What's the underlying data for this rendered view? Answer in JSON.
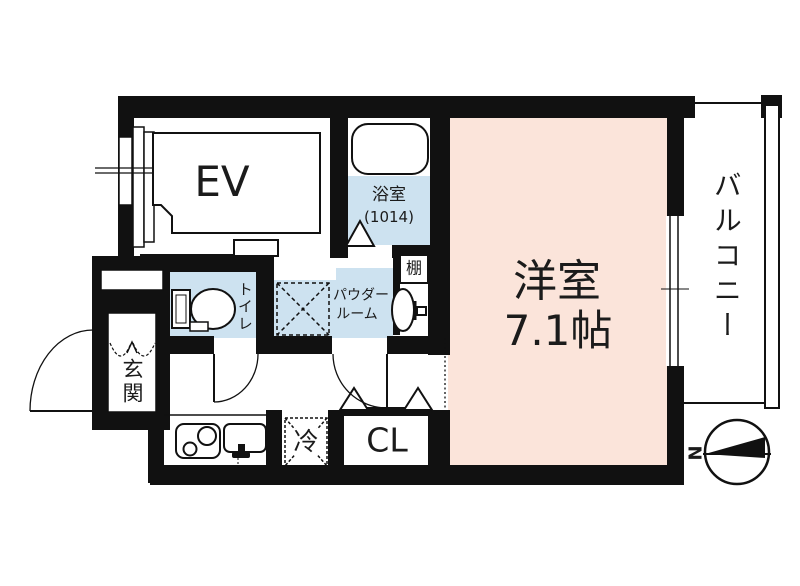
{
  "rooms": {
    "elevator": {
      "label": "EV"
    },
    "bathroom": {
      "label": "浴室",
      "size": "(1014)"
    },
    "shelf": {
      "label": "棚"
    },
    "toilet": {
      "label": "トイレ"
    },
    "powder_room": {
      "line1": "パウダー",
      "line2": "ルーム"
    },
    "entrance": {
      "label": "玄関"
    },
    "refrigerator": {
      "label": "冷"
    },
    "closet": {
      "label": "CL"
    },
    "western_room": {
      "label": "洋室",
      "size": "7.1帖"
    },
    "balcony": {
      "label": "バルコニー"
    }
  },
  "compass": {
    "north": "N"
  },
  "colors": {
    "wall": "#111111",
    "wet_area_floor": "#cde2f0",
    "main_room_floor": "#fbe4da",
    "background": "#ffffff"
  }
}
